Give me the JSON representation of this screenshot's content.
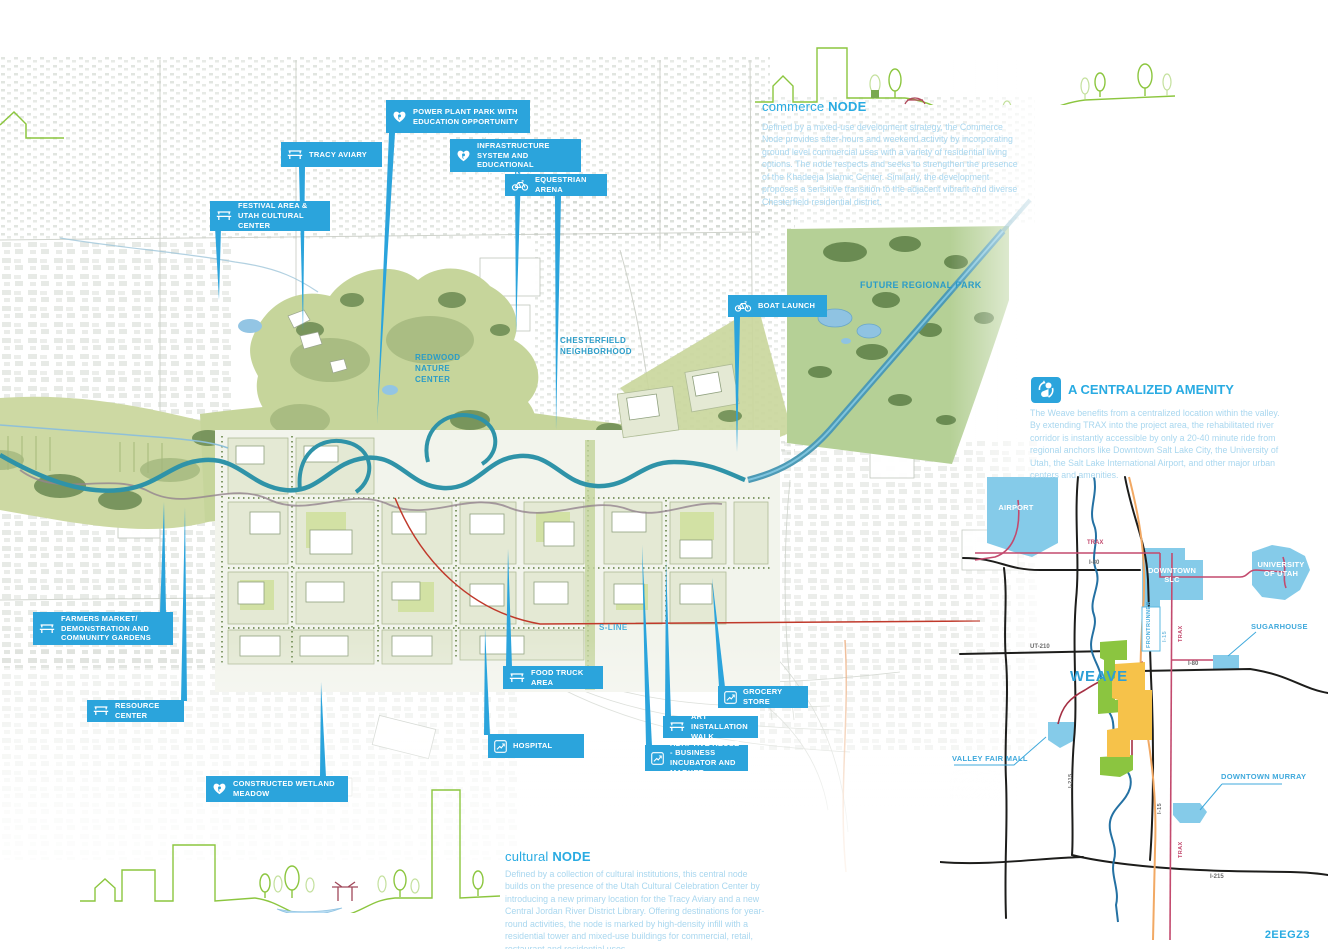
{
  "page": {
    "code": "2EEGZ3"
  },
  "sections": {
    "commerce": {
      "title_light": "commerce ",
      "title_bold": "NODE",
      "body": "Defined by a mixed-use development strategy, the Commerce Node provides after-hours and weekend activity by incorporating ground level commercial uses with a variety of residential living options. The node respects and seeks to strengthen the presence of the Khadeeja Islamic Center. Similarly, the development proposes a sensitive transition to the adjacent vibrant and diverse Chesterfield residential district."
    },
    "cultural": {
      "title_light": "cultural ",
      "title_bold": "NODE",
      "body": "Defined by a collection of cultural institutions, this central node builds on the presence of the Utah Cultural Celebration Center by introducing a new primary location for the Tracy Aviary and a new Central Jordan River District Library. Offering destinations for year-round activities, the node is marked by high-density infill with a residential tower and mixed-use buildings for commercial, retail, restaurant and residential uses."
    },
    "amenity": {
      "title": "A CENTRALIZED AMENITY",
      "body": "The Weave benefits from a centralized location within the valley. By extending TRAX into the project area, the rehabilitated river corridor is instantly accessible by only a 20-40 minute ride from regional anchors like Downtown Salt Lake City, the University of Utah, the Salt Lake International Airport, and other major urban centers and amenities."
    }
  },
  "map_labels": {
    "redwood": "REDWOOD\nNATURE\nCENTER",
    "chesterfield": "CHESTERFIELD\nNEIGHBORHOOD",
    "future_park": "FUTURE REGIONAL PARK",
    "s_line": "S-LINE"
  },
  "callouts": [
    {
      "id": "power-plant-park",
      "icon": "heart",
      "label": "POWER PLANT PARK WITH EDUCATION OPPORTUNITY"
    },
    {
      "id": "tracy-aviary",
      "icon": "bench",
      "label": "TRACY AVIARY"
    },
    {
      "id": "green-infrastructure",
      "icon": "heart",
      "label": "GREEN INFRASTRUCTURE SYSTEM AND EDUCATIONAL OPPORTUNITY"
    },
    {
      "id": "equestrian-arena",
      "icon": "bike",
      "label": "EQUESTRIAN ARENA"
    },
    {
      "id": "festival-area",
      "icon": "bench",
      "label": "FESTIVAL AREA & UTAH CULTURAL CENTER"
    },
    {
      "id": "boat-launch",
      "icon": "bike",
      "label": "BOAT LAUNCH"
    },
    {
      "id": "farmers-market",
      "icon": "bench",
      "label": "FARMERS MARKET/ DEMONSTRATION AND COMMUNITY GARDENS"
    },
    {
      "id": "resource-center",
      "icon": "bench",
      "label": "RESOURCE CENTER"
    },
    {
      "id": "constructed-wetland",
      "icon": "heart",
      "label": "CONSTRUCTED WETLAND MEADOW"
    },
    {
      "id": "food-truck-area",
      "icon": "bench",
      "label": "FOOD TRUCK AREA"
    },
    {
      "id": "hospital",
      "icon": "chart",
      "label": "HOSPITAL"
    },
    {
      "id": "grocery-store",
      "icon": "chart",
      "label": "GROCERY STORE"
    },
    {
      "id": "art-installation-walk",
      "icon": "bench",
      "label": "ART INSTALLATION WALK"
    },
    {
      "id": "adaptive-reuse",
      "icon": "chart",
      "label": "ADAPTIVE REUSE - BUSINESS INCUBATOR AND MARKET"
    }
  ],
  "regional_map": {
    "airport": "AIRPORT",
    "downtown_slc": "DOWNTOWN\nSLC",
    "university": "UNIVERSITY\nOF UTAH",
    "sugarhouse": "SUGARHOUSE",
    "valley_fair": "VALLEY FAIR MALL",
    "downtown_murray": "DOWNTOWN MURRAY",
    "weave": "WEAVE",
    "trax_n": "TRAX",
    "i80_w": "I-80",
    "ut210": "UT-210",
    "i80_e": "I-80",
    "i215_s": "I-215",
    "frontrunner": "FRONTRUNNER",
    "i15_v": "I-15",
    "trax_v": "TRAX",
    "i215_v": "I-215",
    "i15_s": "I-15",
    "trax_s": "TRAX"
  },
  "colors": {
    "callout_blue": "#2BA4DC",
    "heading_blue": "#29ABE2",
    "body_blue": "#a9d7ef",
    "park_green": "#c6d59b",
    "river_teal": "#2f93a8",
    "district_blue": "#85cbe9",
    "trax_pink": "#c34a6e",
    "frontrunner_orange": "#f2a964",
    "sline_red": "#c0392b"
  }
}
